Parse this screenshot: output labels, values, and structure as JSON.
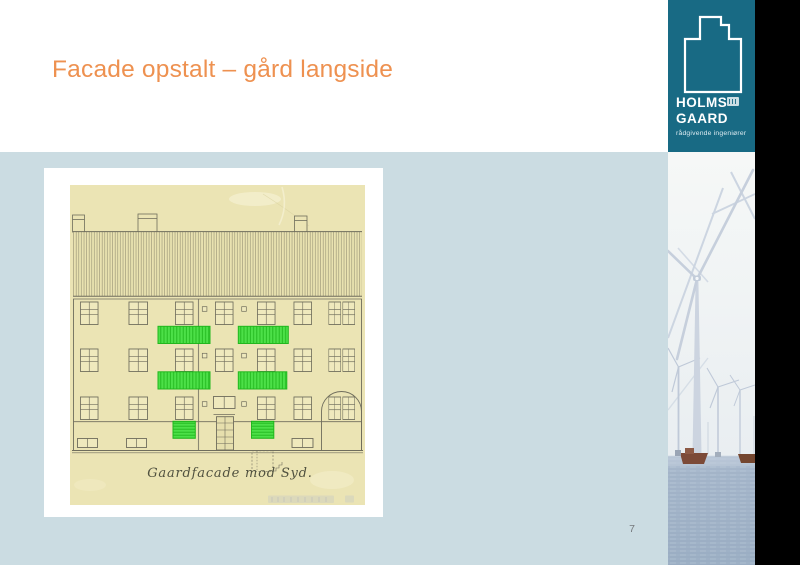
{
  "slide": {
    "title": "Facade opstalt – gård langside",
    "page_number": "7",
    "background_top": "#FFFFFF",
    "background_content": "#CBDCE2",
    "accent_orange": "#EE9150"
  },
  "logo": {
    "brand_teal": "#186A84",
    "line1": "HOLMS",
    "line2": "GAARD",
    "tagline": "rådgivende ingeniører",
    "icon": "stepped-building-outline-icon"
  },
  "figure": {
    "caption": "Gaardfacade mod Syd.",
    "paper_color": "#EBE4B4",
    "highlight_color": "#3FE03F",
    "highlighted_balconies": 4,
    "highlighted_ground_panels": 2
  },
  "sidebar": {
    "photo": "offshore-wind-turbines",
    "strip_color": "#000000"
  }
}
